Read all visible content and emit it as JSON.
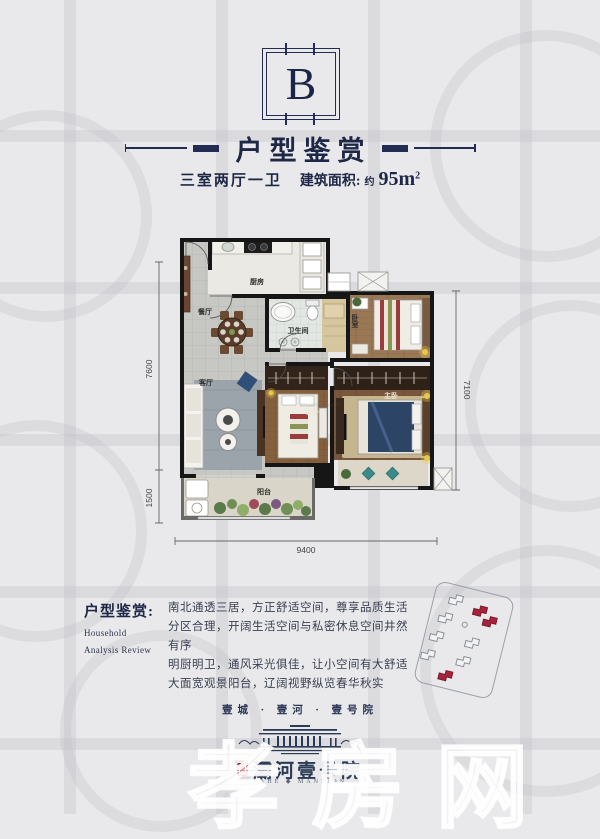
{
  "colors": {
    "navy": "#1e2746",
    "seal_red": "#a7212e",
    "building_red": "#a5233b"
  },
  "unit_badge": {
    "letter": "B"
  },
  "header": {
    "title": "户型鉴赏",
    "subtitle_rooms": "三室两厅一卫",
    "subtitle_area_label": "建筑面积:",
    "subtitle_area_approx": "约",
    "subtitle_area_value": "95m",
    "subtitle_area_sup": "2"
  },
  "floorplan": {
    "rooms": {
      "kitchen": "厨房",
      "dining": "餐厅",
      "bathroom": "卫生间",
      "bedroom": "卧室",
      "master": "主卧",
      "second": "次卧",
      "living": "客厅",
      "balcony": "阳台"
    },
    "dimensions": {
      "left_main": "7600",
      "left_balcony": "1500",
      "right": "7100",
      "bottom": "9400"
    },
    "watermark": "zhuangyi.com"
  },
  "analysis": {
    "heading": "户型鉴赏:",
    "subheading_line1": "Household",
    "subheading_line2": "Analysis Review",
    "paragraph": "南北通透三居，方正舒适空间，尊享品质生活\n分区合理，开阔生活空间与私密休息空间井然有序\n明厨明卫，通风采光俱佳，让小空间有大舒适\n大面宽观景阳台，辽阔视野纵览春华秋实"
  },
  "footer": {
    "tagline": "壹城 · 壹河 · 壹号院",
    "brand_name": "灞河壹号院",
    "brand_sub": "BAHE ◆ MANSION",
    "watermark": "孝房网"
  }
}
